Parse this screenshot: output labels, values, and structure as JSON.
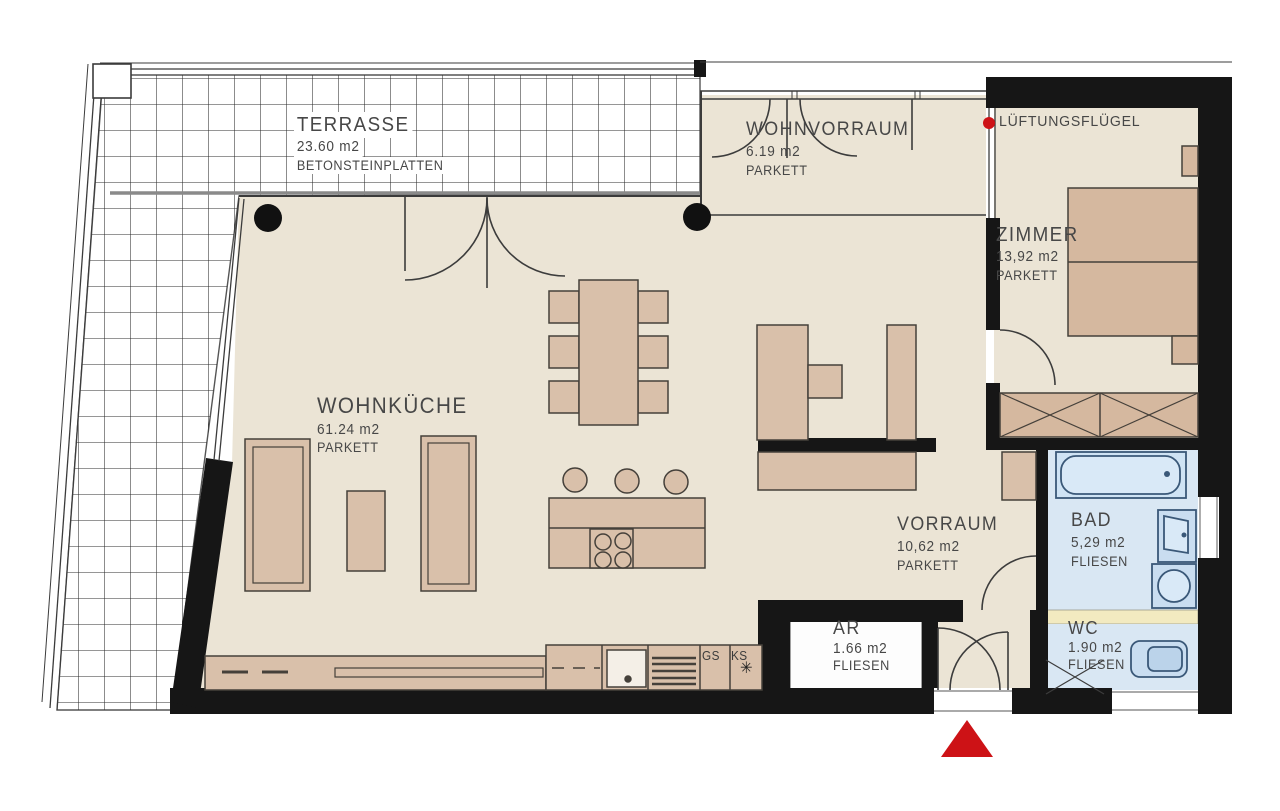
{
  "plan": {
    "rooms": {
      "terrasse": {
        "name": "TERRASSE",
        "area": "23.60 m2",
        "floor": "BETONSTEINPLATTEN"
      },
      "wohnvorraum": {
        "name": "WOHNVORRAUM",
        "area": "6.19 m2",
        "floor": "PARKETT"
      },
      "zimmer": {
        "name": "ZIMMER",
        "area": "13,92 m2",
        "floor": "PARKETT"
      },
      "wohnkueche": {
        "name": "WOHNKÜCHE",
        "area": "61.24 m2",
        "floor": "PARKETT"
      },
      "vorraum": {
        "name": "VORRAUM",
        "area": "10,62 m2",
        "floor": "PARKETT"
      },
      "bad": {
        "name": "BAD",
        "area": "5,29 m2",
        "floor": "FLIESEN"
      },
      "ar": {
        "name": "AR",
        "area": "1.66 m2",
        "floor": "FLIESEN"
      },
      "wc": {
        "name": "WC",
        "area": "1.90 m2",
        "floor": "FLIESEN"
      }
    },
    "annotations": {
      "ventilation": "LÜFTUNGSFLÜGEL",
      "dishwasher": "GS",
      "fridge": "KS",
      "fridge_symbol": "✳"
    },
    "colors": {
      "floor_beige": "#EBE4D5",
      "furniture_tan": "#D9C0AA",
      "furniture_dark_tan": "#D5B89F",
      "tile_blue": "#D9E7F3",
      "fixture_blue": "#C9DDF0",
      "wall_black": "#161616",
      "accent_red": "#CD1216",
      "wall_band_yellow": "#F2EAC0"
    }
  }
}
